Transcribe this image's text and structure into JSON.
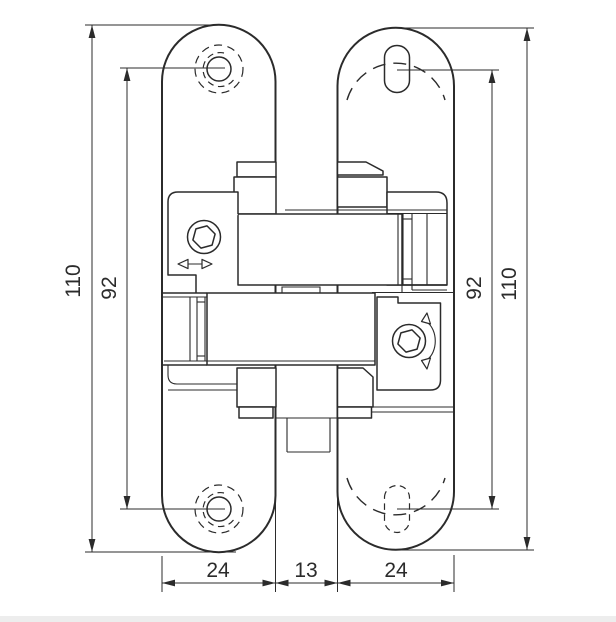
{
  "drawing": {
    "type": "technical-dimension-drawing",
    "subject": "concealed hinge, front view with mounting plates",
    "colors": {
      "line": "#2b2b2b",
      "background": "#ffffff",
      "footer_strip": "#ededed"
    },
    "dimensions": {
      "left_overall_height": "110",
      "left_hole_spacing": "92",
      "right_hole_spacing": "92",
      "right_overall_height": "110",
      "bottom_left_plate_width": "24",
      "bottom_center_gap": "13",
      "bottom_right_plate_width": "24"
    }
  }
}
